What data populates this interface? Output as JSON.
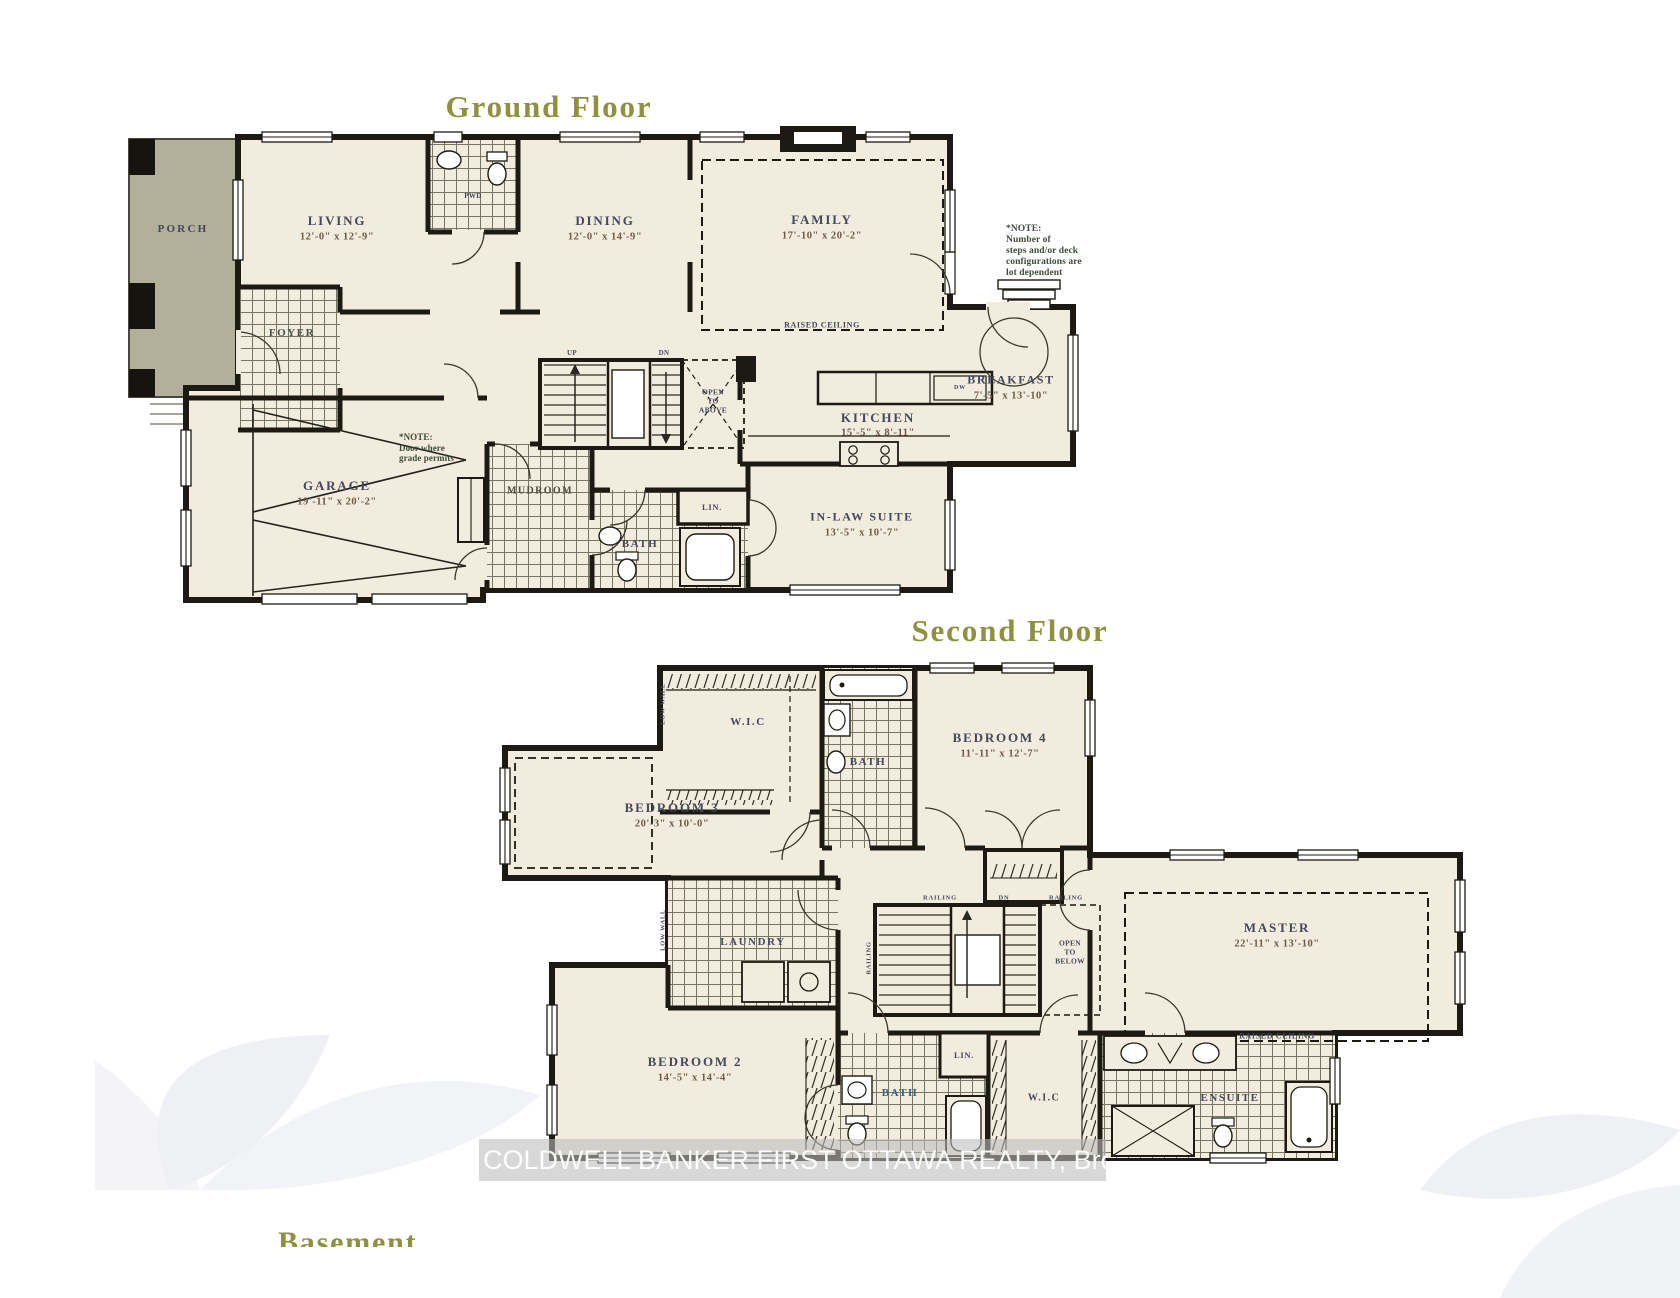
{
  "ground": {
    "title": "Ground Floor",
    "porch": "PORCH",
    "foyer": "FOYER",
    "pwd": "PWD",
    "living": {
      "name": "LIVING",
      "dim": "12'-0\" x 12'-9\""
    },
    "dining": {
      "name": "DINING",
      "dim": "12'-0\" x 14'-9\""
    },
    "family": {
      "name": "FAMILY",
      "dim": "17'-10\" x 20'-2\"",
      "ceiling": "RAISED CEILING"
    },
    "kitchen": {
      "name": "KITCHEN",
      "dim": "15'-5\" x 8'-11\"",
      "dw": "DW"
    },
    "breakfast": {
      "name": "BREAKFAST",
      "dim": "7'-5\" x 13'-10\""
    },
    "garage": {
      "name": "GARAGE",
      "dim": "19'-11\" x 20'-2\""
    },
    "inlaw": {
      "name": "IN-LAW SUITE",
      "dim": "13'-5\" x 10'-7\""
    },
    "mudroom": "MUDROOM",
    "bath": "BATH",
    "linen": "LIN.",
    "stairs": {
      "up": "UP",
      "dn": "DN"
    },
    "open_above": {
      "l1": "OPEN",
      "l2": "TO",
      "l3": "ABOVE"
    },
    "deck_note": {
      "l1": "*NOTE:",
      "l2": "Number of",
      "l3": "steps and/or deck",
      "l4": "configurations are",
      "l5": "lot dependent"
    },
    "garage_note": {
      "l1": "*NOTE:",
      "l2": "Door where",
      "l3": "grade permits"
    }
  },
  "second": {
    "title": "Second Floor",
    "wic_top": "W.I.C",
    "bath_top": "BATH",
    "bedroom4": {
      "name": "BEDROOM 4",
      "dim": "11'-11\" x 12'-7\""
    },
    "bedroom3": {
      "name": "BEDROOM 3",
      "dim": "20'-3\" x 10'-0\""
    },
    "bedroom2": {
      "name": "BEDROOM 2",
      "dim": "14'-5\" x 14'-4\""
    },
    "master": {
      "name": "MASTER",
      "dim": "22'-11\" x 13'-10\"",
      "ceiling": "RAISED CEILING"
    },
    "laundry": "LAUNDRY",
    "bath_low": "BATH",
    "linen": "LIN.",
    "wic_low": "W.I.C",
    "ensuite": "ENSUITE",
    "open_below": {
      "l1": "OPEN",
      "l2": "TO",
      "l3": "BELOW"
    },
    "railing_left": "RAILING",
    "railing_right": "RAILING",
    "railing_side": "RAILING",
    "dn": "DN",
    "low_wall_top": "LOW WALL",
    "low_wall_mid": "LOW WALL"
  },
  "basement": {
    "title": "Basement"
  },
  "watermark": {
    "text": "COLDWELL BANKER FIRST OTTAWA REALTY, Brokerage"
  },
  "colors": {
    "title_olive": "#8e9140",
    "wall": "#1c1a12",
    "floor": "#f1ecdd",
    "porch": "#b2b09a"
  }
}
